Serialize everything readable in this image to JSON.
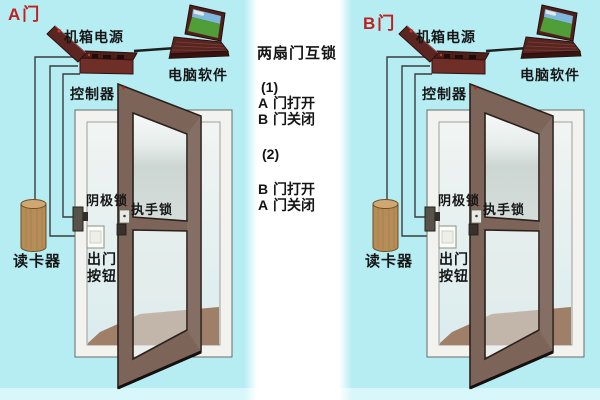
{
  "panels": [
    {
      "door_label": "A门",
      "labels": {
        "power_supply": "机箱电源",
        "computer_software": "电脑软件",
        "controller": "控制器",
        "cathode_lock": "阴极锁",
        "handle_lock": "执手锁",
        "exit_button_line1": "出门",
        "exit_button_line2": "按钮",
        "card_reader": "读卡器"
      }
    },
    {
      "door_label": "B门",
      "labels": {
        "power_supply": "机箱电源",
        "computer_software": "电脑软件",
        "controller": "控制器",
        "cathode_lock": "阴极锁",
        "handle_lock": "执手锁",
        "exit_button_line1": "出门",
        "exit_button_line2": "按钮",
        "card_reader": "读卡器"
      }
    }
  ],
  "middle": {
    "title": "两扇门互锁",
    "rules": [
      {
        "num": "(1)",
        "lines": [
          {
            "door": "A",
            "state": "门打开"
          },
          {
            "door": "B",
            "state": "门关闭"
          }
        ]
      },
      {
        "num": "(2)",
        "lines": [
          {
            "door": "B",
            "state": "门打开"
          },
          {
            "door": "A",
            "state": "门关闭"
          }
        ]
      }
    ]
  },
  "colors": {
    "panel_background": "#b5edf3",
    "bottom_strip": "#d8f7fa",
    "middle_background": "#ffffff",
    "door_leaf_brown": "#7c6459",
    "door_frame_white": "#f2f3ef",
    "floor_wedge": "#a07f68",
    "device_maroon": "#6f2d27",
    "card_reader_tan": "#b68d58",
    "laptop_screen_green": "#4f9e38",
    "laptop_screen_sky": "#7fb8dc",
    "door_label_red": "#bf1f1f",
    "label_black": "#161616"
  }
}
